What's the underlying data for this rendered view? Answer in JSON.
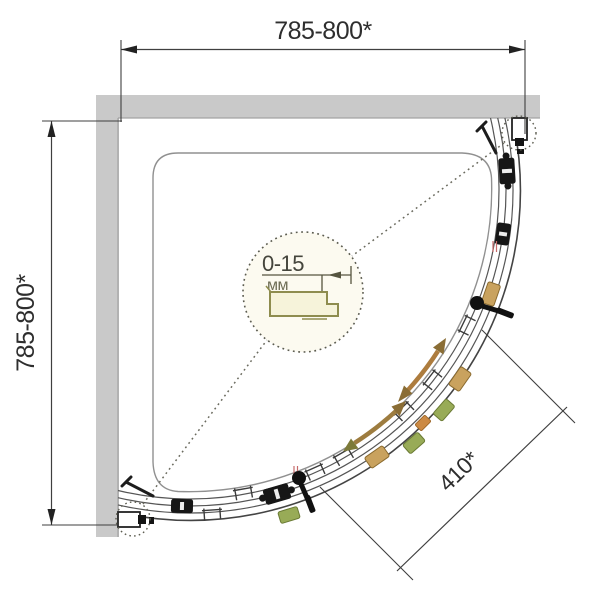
{
  "diagram": {
    "dimensions": {
      "width_top": "785-800*",
      "depth_left": "785-800*",
      "entry_diagonal": "410*"
    },
    "detail": {
      "adjustment_range": "0-15",
      "unit": "мм"
    },
    "colors": {
      "wall": "#c9c9c9",
      "line": "#4f4f4f",
      "dimension_text": "#2e2e2e",
      "arrow_brown": "#a97e44",
      "arrow_head": "#8a6d35",
      "profile_olive": "#8e8c4e",
      "profile_fill": "#f6f3da",
      "hardware_tan": "#c9a25e",
      "hardware_green": "#98ab57",
      "hardware_orange": "#cc8a44",
      "accent_red": "#c66a6a"
    },
    "elements": {
      "walls": "two gray walls, top and left",
      "tray": "quarter-round shower tray outline",
      "doors": "curved sliding door rails with rollers and two handles",
      "detail_view": "dotted magnifier circle showing wall profile adjustment"
    }
  }
}
